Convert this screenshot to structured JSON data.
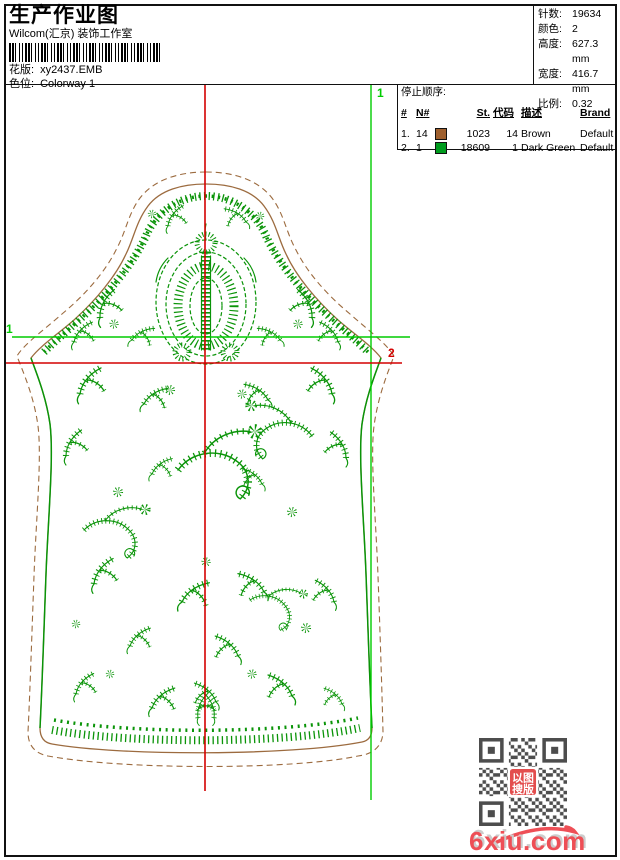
{
  "header": {
    "title": "生产作业图",
    "studio": "Wilcom(汇京) 装饰工作室",
    "design_label": "花版:",
    "design_value": "xy2437.EMB",
    "colorway_label": "色位:",
    "colorway_value": "Colorway 1"
  },
  "stats": {
    "items": [
      {
        "label": "针数:",
        "value": "19634"
      },
      {
        "label": "颜色:",
        "value": "2"
      },
      {
        "label": "高度:",
        "value": "627.3 mm"
      },
      {
        "label": "宽度:",
        "value": "416.7 mm"
      },
      {
        "label": "比例:",
        "value": "0.32"
      }
    ]
  },
  "stop_sequence": {
    "title": "停止顺序:",
    "columns": {
      "idx": "#",
      "n": "N#",
      "st": "St.",
      "code": "代码",
      "desc": "描述",
      "brand": "Brand",
      "elem": "元素"
    },
    "rows": [
      {
        "idx": "1.",
        "n": "14",
        "color": "#9e5f2e",
        "st": "1023",
        "code": "14",
        "desc": "Brown",
        "brand": "Default",
        "elem": ""
      },
      {
        "idx": "2.",
        "n": "1",
        "color": "#009c1e",
        "st": "18609",
        "code": "1",
        "desc": "Dark Green",
        "brand": "Default",
        "elem": ""
      }
    ]
  },
  "design": {
    "marker_green": "1",
    "marker_red": "2",
    "colors": {
      "embroidery_green": "#0a9408",
      "outline_brown": "#9c6b3f",
      "guide_green": "#00cc00",
      "guide_red": "#d40000"
    }
  },
  "watermark": {
    "site": "6xiu.com",
    "stamp_line1": "以图",
    "stamp_line2": "搜版"
  }
}
